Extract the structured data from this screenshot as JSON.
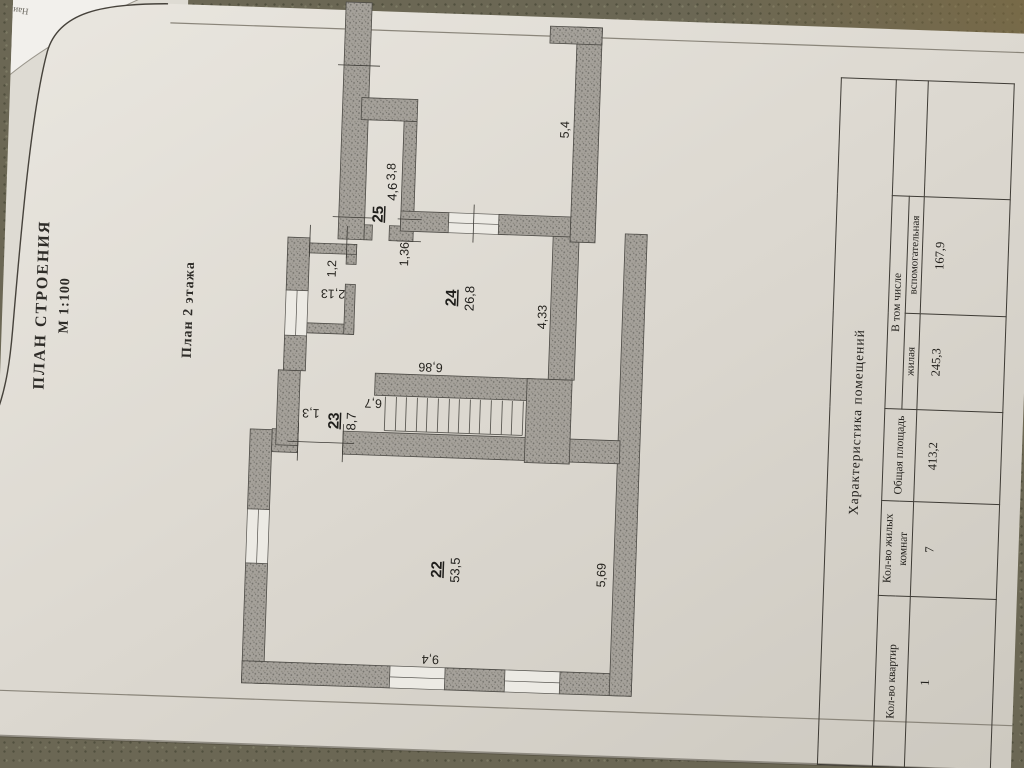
{
  "titles": {
    "main": "ПЛАН СТРОЕНИЯ",
    "scale": "М 1:100",
    "floor": "План 2 этажа"
  },
  "under_sheet": {
    "fragment1": "Наимено",
    "fragment2": "ЧЕЛ"
  },
  "rooms": [
    {
      "number": "22",
      "area": "53,5"
    },
    {
      "number": "23",
      "area": "8,7"
    },
    {
      "number": "24",
      "area": "26,8"
    },
    {
      "number": "25",
      "area": "4,6"
    }
  ],
  "dims": {
    "d54": "5,4",
    "d38": "3,8",
    "d136": "1,36",
    "d12": "1,2",
    "d213": "2,13",
    "d433": "4,33",
    "d686": "6,86",
    "d67": "6,7",
    "d13": "1,3",
    "d569": "5,69",
    "d94": "9,4"
  },
  "table": {
    "title": "Характеристика помещений",
    "columns": {
      "c1": "Кол-во квартир",
      "c2": "Кол-во жилых комнат",
      "c3": "Общая площадь",
      "group": "В том числе",
      "c4": "жилая",
      "c5": "вспомогательная"
    },
    "values": {
      "v1": "1",
      "v2": "7",
      "v3": "413,2",
      "v4": "245,3",
      "v5": "167,9"
    }
  }
}
